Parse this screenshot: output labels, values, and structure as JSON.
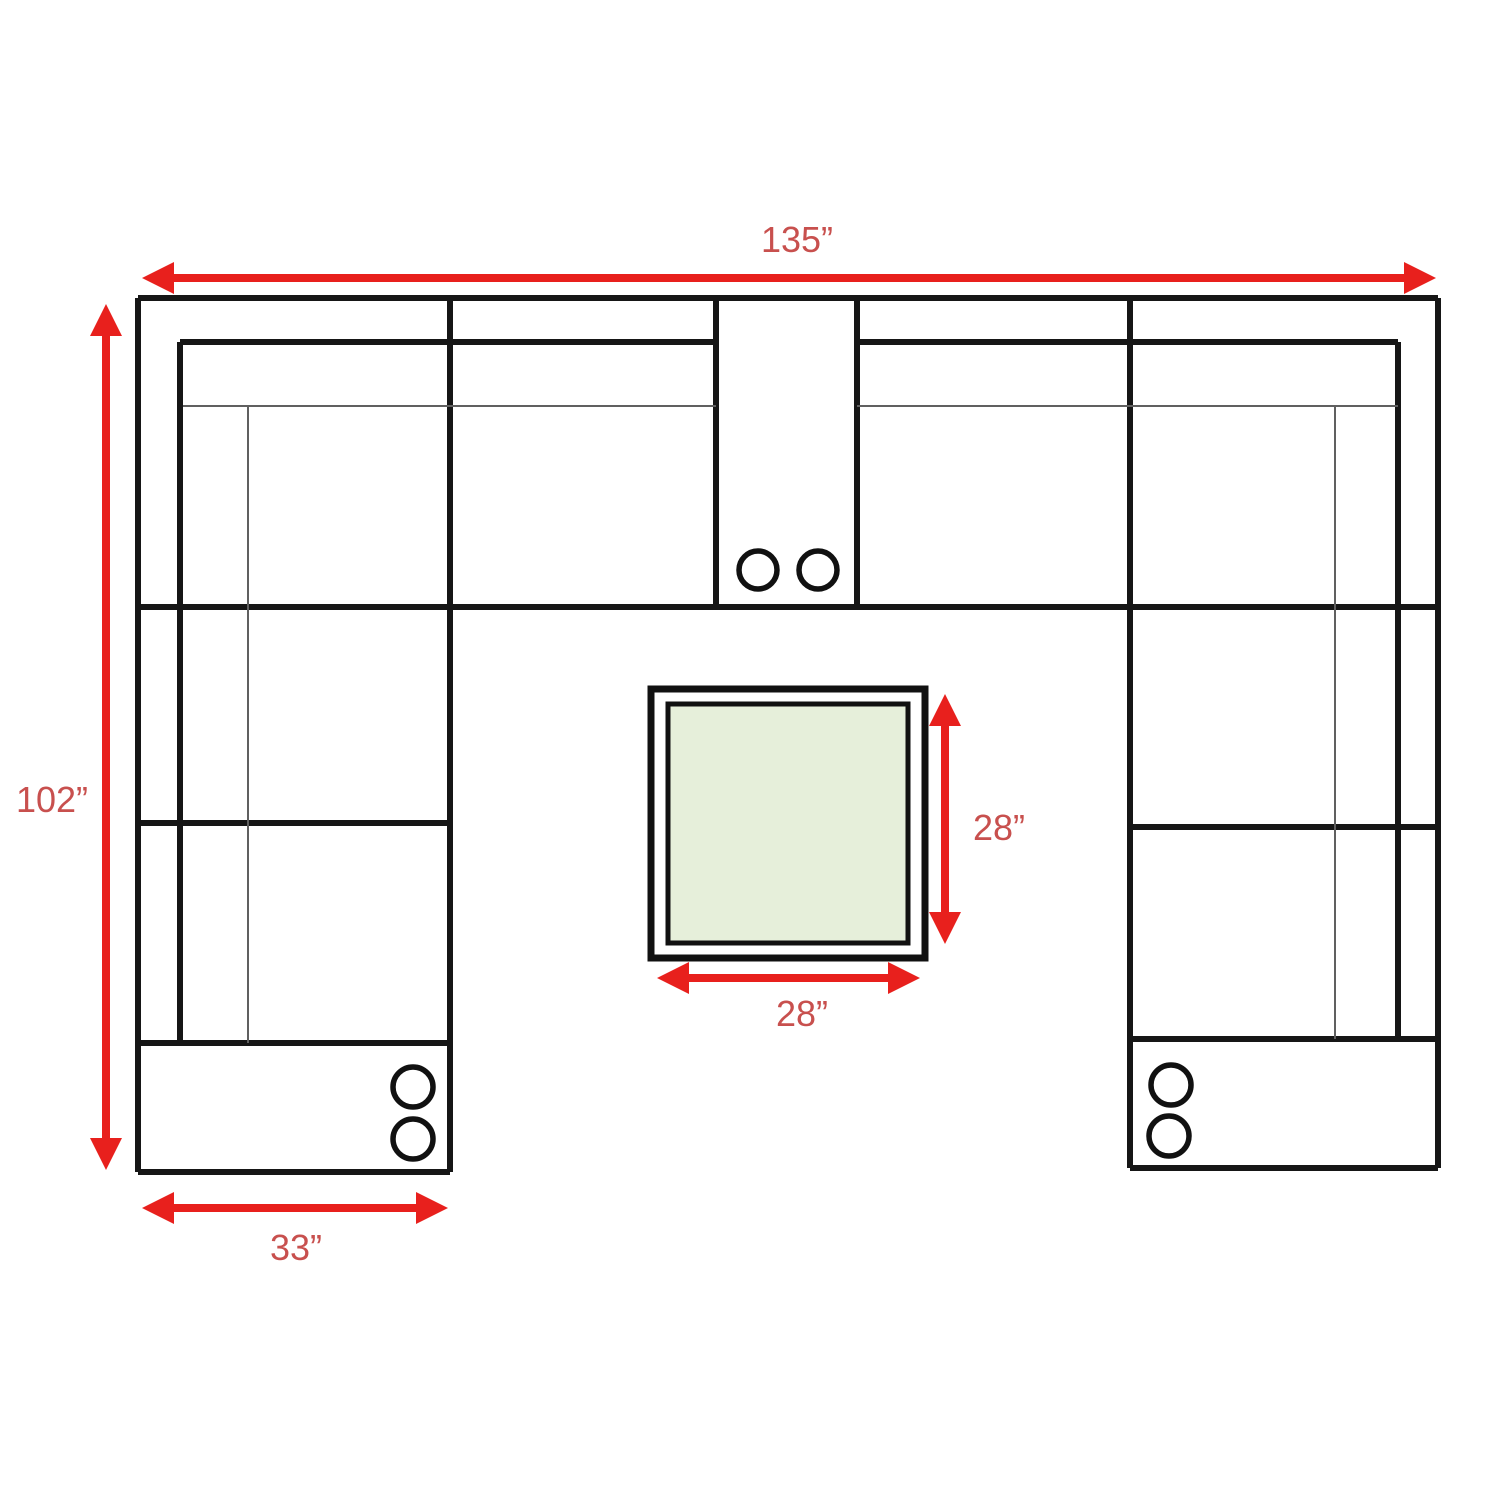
{
  "diagram": {
    "type": "sectional-sofa-floor-plan",
    "labels": {
      "overall_width": "135”",
      "overall_depth": "102”",
      "left_console_width": "33”",
      "table_depth": "28”",
      "table_width": "28”"
    },
    "colors": {
      "arrow-red": "#e8201d",
      "label-red": "#c8504e",
      "line-black": "#161616",
      "line-gray": "#606060",
      "table-fill": "#e6efda",
      "background": "#ffffff"
    }
  }
}
